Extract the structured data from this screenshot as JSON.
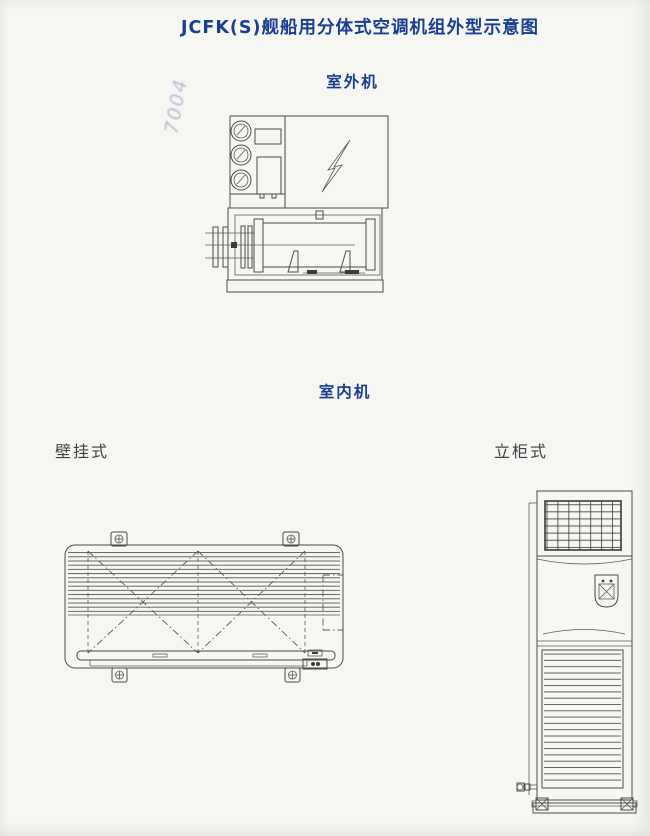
{
  "page_title": "JCFK(S)舰船用分体式空调机组外型示意图",
  "watermark_stamp": "7004",
  "labels": {
    "outdoor_unit": "室外机",
    "indoor_unit": "室内机",
    "wall_mounted": "壁挂式",
    "floor_cabinet": "立柜式"
  },
  "colors": {
    "accent_blue": "#1b3e8f",
    "label_dark": "#3f4144",
    "line_gray": "#4a4a4a",
    "paper": "#f6f6f3"
  }
}
